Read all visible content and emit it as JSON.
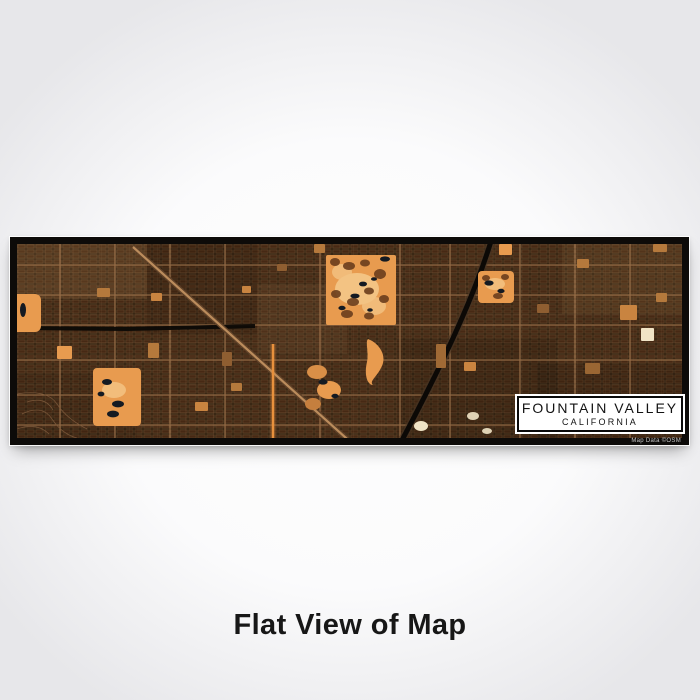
{
  "product": {
    "caption": "Flat View of Map"
  },
  "map_label": {
    "title": "FOUNTAIN VALLEY",
    "subtitle": "CALIFORNIA",
    "credit": "Map Data ©OSM"
  },
  "map_style": {
    "name": "ember",
    "orientation": "wide-panoramic"
  },
  "colors": {
    "page-bg-edge": "#e7e7ea",
    "page-bg-center": "#fefefe",
    "map-border": "#0d0b09",
    "map-base": "#31200f",
    "block-fill": "#462914",
    "street": "#7d5a3c",
    "arterial": "#a1754d",
    "park-orange": "#e89b4f",
    "park-light": "#f3c383",
    "tree": "#6b3d1d",
    "pond": "#141a22",
    "river": "#0c0906",
    "freeway": "#bb8c5c",
    "glow-orange": "#e8913d",
    "cream": "#f1e4c6",
    "caption-text": "#171717",
    "label-text": "#131313",
    "credit-text": "#c9c9c9"
  }
}
